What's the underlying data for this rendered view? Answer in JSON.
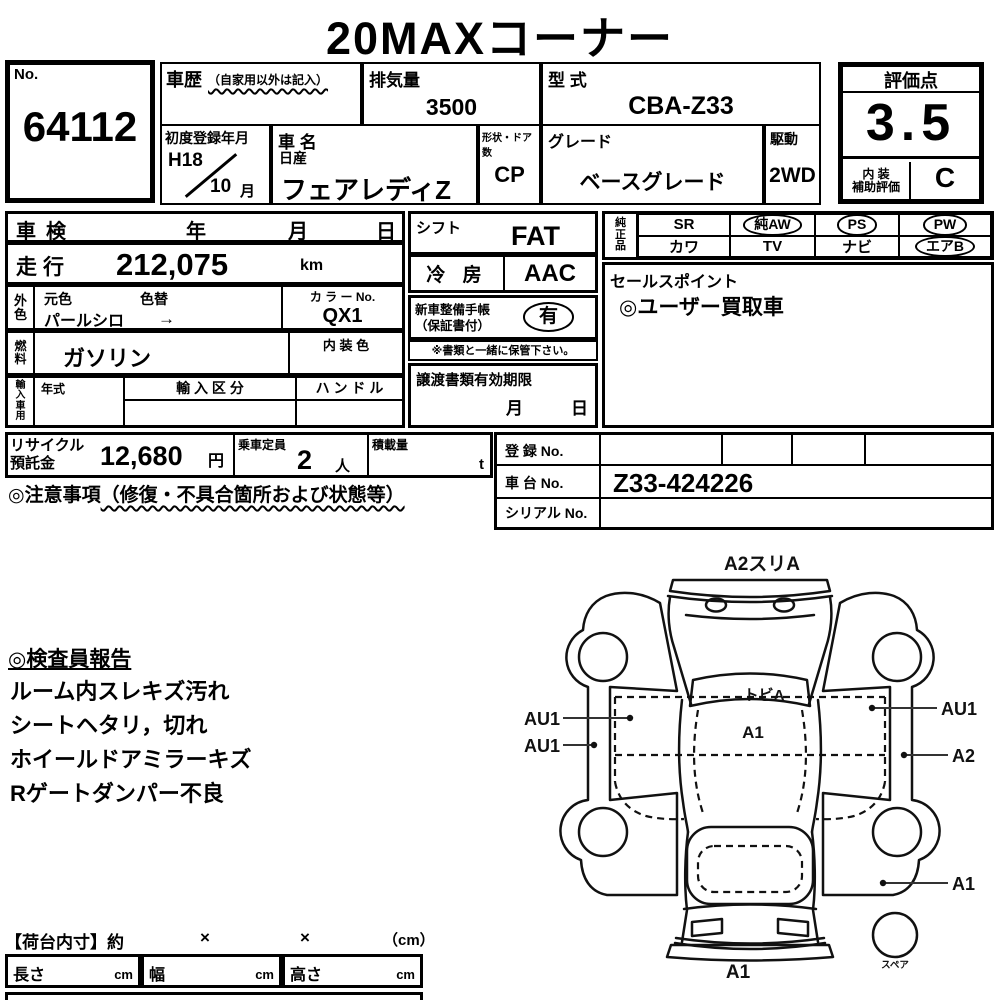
{
  "title": "20MAXコーナー",
  "colors": {
    "ink": "#000000",
    "paper": "#ffffff"
  },
  "lot": {
    "label": "No.",
    "number": "64112"
  },
  "header": {
    "history": {
      "label": "車歴",
      "note": "（自家用以外は記入）",
      "value": ""
    },
    "displacement": {
      "label": "排気量",
      "value": "3500"
    },
    "model_code": {
      "label": "型 式",
      "value": "CBA-Z33"
    },
    "first_reg": {
      "label": "初度登録年月",
      "year": "H18",
      "month": "10",
      "month_unit": "月"
    },
    "car_name": {
      "label": "車 名",
      "maker": "日産",
      "value": "フェアレディZ"
    },
    "body_doors": {
      "label": "形状・ドア数",
      "value": "CP"
    },
    "grade": {
      "label": "グレード",
      "value": "ベースグレード"
    },
    "drive": {
      "label": "駆動",
      "value": "2WD"
    }
  },
  "rating": {
    "label": "評価点",
    "score": "3.5",
    "interior_label_1": "内 装",
    "interior_label_2": "補助評価",
    "interior_grade": "C"
  },
  "left": {
    "shaken": {
      "label": "車検",
      "year": "年",
      "month": "月",
      "day": "日"
    },
    "mileage": {
      "label": "走行",
      "value": "212,075",
      "unit": "km"
    },
    "ext_color": {
      "label_1": "外",
      "label_2": "色",
      "orig": "元色",
      "change": "色替",
      "value": "パールシロ",
      "arrow": "→"
    },
    "color_no": {
      "label": "カ ラ ー No.",
      "value": "QX1"
    },
    "fuel": {
      "label_1": "燃",
      "label_2": "料",
      "value": "ガソリン"
    },
    "interior_color": {
      "label": "内 装 色",
      "value": ""
    },
    "import": {
      "label_1": "輸",
      "label_2": "入",
      "label_3": "車",
      "label_4": "用",
      "year_label": "年式",
      "division_label": "輸 入 区 分",
      "handle_label": "ハ ン ド ル"
    },
    "recycle": {
      "label_1": "リサイクル",
      "label_2": "預託金",
      "value": "12,680",
      "unit": "円"
    },
    "capacity": {
      "label": "乗車定員",
      "value": "2",
      "unit": "人"
    },
    "payload": {
      "label": "積載量",
      "value": "",
      "unit": "t"
    },
    "notice": {
      "prefix": "◎注意事項",
      "paren": "（修復・不具合箇所および状態等）"
    }
  },
  "middle": {
    "shift": {
      "label": "シフト",
      "value": "FAT"
    },
    "ac": {
      "label": "冷 房",
      "value": "AAC"
    },
    "service_book": {
      "label_1": "新車整備手帳",
      "label_2": "（保証書付）",
      "value": "有"
    },
    "keep_note": "※書類と一緒に保管下さい。",
    "transfer": {
      "label": "譲渡書類有効期限",
      "month": "月",
      "day": "日"
    }
  },
  "right": {
    "oem": {
      "label_1": "純",
      "label_2": "正",
      "label_3": "品",
      "items": [
        {
          "label": "SR",
          "circled": false
        },
        {
          "label": "純AW",
          "circled": true
        },
        {
          "label": "PS",
          "circled": true
        },
        {
          "label": "PW",
          "circled": true
        },
        {
          "label": "カワ",
          "circled": false
        },
        {
          "label": "TV",
          "circled": false
        },
        {
          "label": "ナビ",
          "circled": false
        },
        {
          "label": "エアB",
          "circled": true
        }
      ]
    },
    "sales": {
      "label": "セールスポイント",
      "value": "◎ユーザー買取車"
    },
    "registration": {
      "label": "登 録 No.",
      "value": ""
    },
    "chassis": {
      "label": "車 台 No.",
      "value": "Z33-424226"
    },
    "serial": {
      "label": "シリアル No.",
      "value": ""
    }
  },
  "report": {
    "title": "◎検査員報告",
    "lines": [
      "ルーム内スレキズ汚れ",
      "シートヘタリ，切れ",
      "ホイールドアミラーキズ",
      "Rゲートダンパー不良"
    ]
  },
  "diagram": {
    "top": "A2スリA",
    "windshield": "トビA",
    "roof": "A1",
    "left_door": "AU1",
    "left_sill": "AU1",
    "right_door": "AU1",
    "right_sill": "A2",
    "right_quarter": "A1",
    "rear": "A1",
    "spare": "スペア"
  },
  "cargo": {
    "title": "【荷台内寸】約",
    "times_1": "×",
    "times_2": "×",
    "unit": "（cm）",
    "length": "長さ",
    "width": "幅",
    "height": "高さ",
    "cm_1": "cm",
    "cm_2": "cm",
    "cm_3": "cm"
  }
}
